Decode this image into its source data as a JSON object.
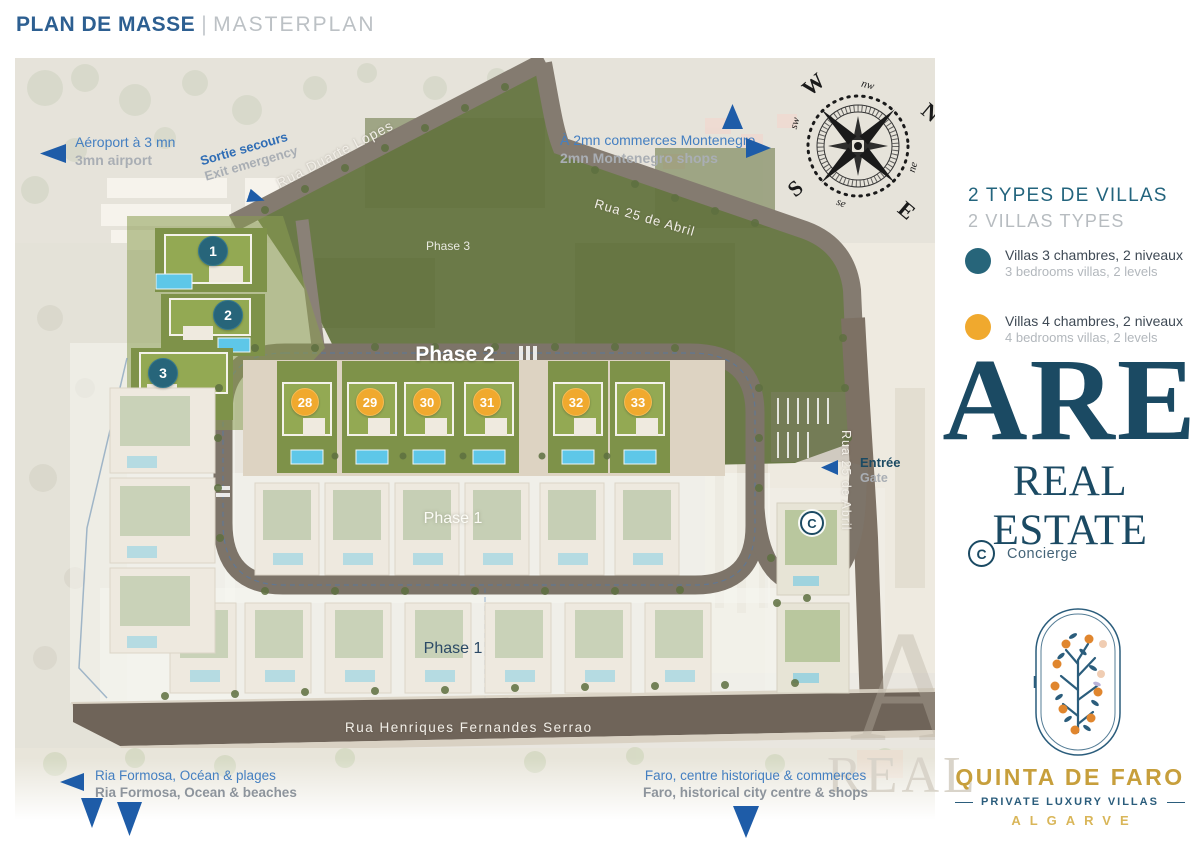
{
  "header": {
    "title_fr": "PLAN DE MASSE",
    "separator": "|",
    "title_en": "MASTERPLAN"
  },
  "map": {
    "pois": {
      "airport": {
        "fr": "Aéroport à 3 mn",
        "en": "3mn airport"
      },
      "emergency": {
        "fr": "Sortie secours",
        "en": "Exit emergency"
      },
      "shops": {
        "fr": "À 2mn commerces Montenegro",
        "en": "2mn Montenegro shops"
      },
      "entrance": {
        "fr": "Entrée",
        "en": "Gate"
      },
      "ria": {
        "fr": "Ria Formosa, Océan & plages",
        "en": "Ria Formosa, Ocean & beaches"
      },
      "faro": {
        "fr": "Faro, centre historique & commerces",
        "en": "Faro, historical city centre & shops"
      }
    },
    "roads": {
      "duarte": "Rua Duarte Lopes",
      "abril_top": "Rua 25 de Abril",
      "abril_side": "Rua 25 de Abril",
      "serrao": "Rua Henriques Fernandes Serrao"
    },
    "phases": {
      "phase1_upper": "Phase 1",
      "phase1_lower": "Phase 1",
      "phase2": "Phase 2",
      "phase3": "Phase 3"
    },
    "compass": {
      "w": "W",
      "n": "N",
      "s": "S",
      "e": "E",
      "nw": "nw",
      "ne": "ne",
      "sw": "sw",
      "se": "se"
    },
    "markers": [
      {
        "label": "1",
        "type": "teal"
      },
      {
        "label": "2",
        "type": "teal"
      },
      {
        "label": "3",
        "type": "teal"
      },
      {
        "label": "28",
        "type": "orange"
      },
      {
        "label": "29",
        "type": "orange"
      },
      {
        "label": "30",
        "type": "orange"
      },
      {
        "label": "31",
        "type": "orange"
      },
      {
        "label": "32",
        "type": "orange"
      },
      {
        "label": "33",
        "type": "orange"
      },
      {
        "label": "C",
        "type": "concierge"
      }
    ],
    "watermark": {
      "letter": "A",
      "text": "REAL"
    }
  },
  "sidebar": {
    "types_title_fr": "2 TYPES DE VILLAS",
    "types_title_en": "2 VILLAS TYPES",
    "legend": [
      {
        "color": "#27657a",
        "fr": "Villas 3 chambres, 2 niveaux",
        "en": "3 bedrooms villas, 2 levels"
      },
      {
        "color": "#f0a92e",
        "fr": "Villas 4 chambres, 2 niveaux",
        "en": "4 bedrooms villas, 2 levels"
      }
    ],
    "brand": {
      "acronym": "ARE",
      "name": "REAL ESTATE"
    },
    "concierge": {
      "symbol": "C",
      "label": "Concierge"
    },
    "logo": {
      "name": "QUINTA DE FARO",
      "tagline": "PRIVATE LUXURY VILLAS",
      "region": "ALGARVE"
    }
  },
  "colors": {
    "title_blue": "#2d5f91",
    "teal": "#27657a",
    "orange": "#f0a92e",
    "navy": "#1b4a63",
    "arrow_blue": "#1e5ca8",
    "label_blue": "#447fc1",
    "label_gray": "#9aa1a8",
    "gold": "#c79f3c",
    "field_green": "#6b7a48"
  }
}
